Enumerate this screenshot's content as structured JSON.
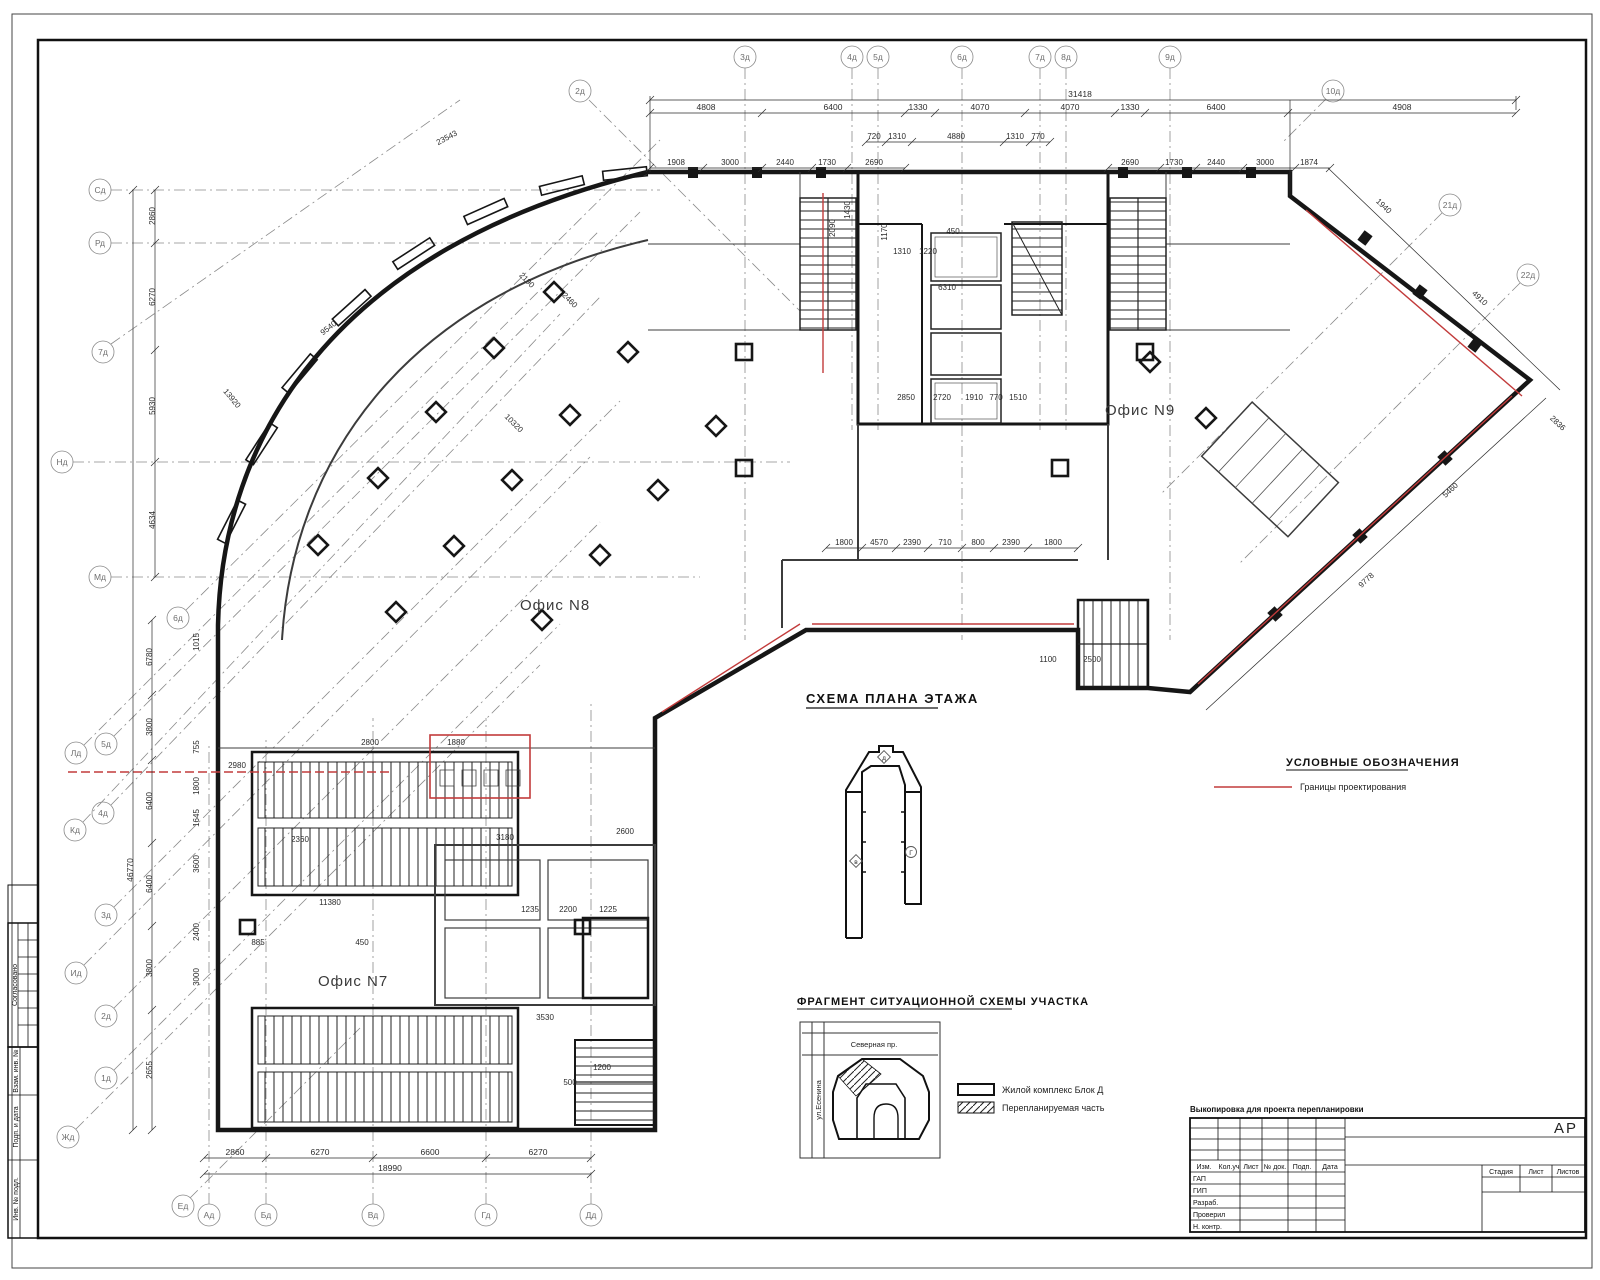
{
  "sheet": {
    "stamp_strip": {
      "agreed_label": "Согласовано",
      "rows": [
        "Взам. инв. №",
        "Подп. и дата",
        "Инв. № подл."
      ]
    }
  },
  "plan": {
    "offices": {
      "n7": "Офис N7",
      "n8": "Офис N8",
      "n9": "Офис N9"
    },
    "axes": {
      "top": [
        "2д",
        "3д",
        "4д",
        "5д",
        "6д",
        "7д",
        "8д",
        "9д",
        "10д"
      ],
      "right": [
        "21д",
        "22д"
      ],
      "left": [
        "Сд",
        "Рд",
        "7д",
        "Нд",
        "Мд",
        "6д",
        "Лд",
        "5д",
        "Кд",
        "4д",
        "3д",
        "Ид",
        "2д",
        "1д",
        "Жд"
      ],
      "bottom": [
        "Ед",
        "Ад",
        "Бд",
        "Вд",
        "Гд",
        "Дд"
      ]
    }
  },
  "dims": {
    "top_total": "31418",
    "top_chain": [
      "4808",
      "6400",
      "1330",
      "4070",
      "4070",
      "1330",
      "6400",
      "4908"
    ],
    "top_sub_left": [
      "1908",
      "3000",
      "2440",
      "1730",
      "2690"
    ],
    "top_sub_right": [
      "2690",
      "1730",
      "2440",
      "3000",
      "1874"
    ],
    "core_top": [
      "720",
      "1310",
      "4880",
      "1310",
      "770"
    ],
    "bottom_chain": [
      "2860",
      "6270",
      "6600",
      "6270"
    ],
    "bottom_total": "18990",
    "left_upper": [
      "2860",
      "6270",
      "5930",
      "4634"
    ],
    "left_lower": [
      "6780",
      "3800",
      "6400",
      "6400",
      "3800",
      "2655"
    ],
    "left_total": "46770",
    "right_diag": [
      "1940",
      "4910",
      "5460",
      "2836",
      "9778"
    ],
    "mid_chain": [
      "1800",
      "4570",
      "2390",
      "710",
      "800",
      "2390",
      "1800"
    ],
    "arc": [
      "23543",
      "13920",
      "10320",
      "2190",
      "2460",
      "9540"
    ],
    "interior": [
      "2850",
      "2720",
      "1910",
      "770",
      "1510",
      "6310",
      "1310",
      "1220",
      "450",
      "1170",
      "2090",
      "1430",
      "2980",
      "2800",
      "1880",
      "3180",
      "2360",
      "11380",
      "885",
      "450",
      "3530",
      "2600",
      "1100",
      "2500",
      "1200",
      "500",
      "1235",
      "2200",
      "1225",
      "1645",
      "3600",
      "2400",
      "3000",
      "1015",
      "755",
      "1800"
    ]
  },
  "floor_scheme": {
    "title": "СХЕМА ПЛАНА ЭТАЖА",
    "markers": [
      "д",
      "в",
      "Г"
    ]
  },
  "legend": {
    "title": "УСЛОВНЫЕ ОБОЗНАЧЕНИЯ",
    "item1": "Границы проектирования"
  },
  "fragment": {
    "title": "ФРАГМЕНТ СИТУАЦИОННОЙ СХЕМЫ УЧАСТКА",
    "street_top": "Северная пр.",
    "street_left": "ул.Есенина",
    "legend_solid": "Жилой комплекс Блок Д",
    "legend_hatch": "Перепланируемая часть"
  },
  "title_block": {
    "note": "Выкопировка для проекта перепланировки",
    "code": "АР",
    "cols": [
      "Изм.",
      "Кол.уч",
      "Лист",
      "№ док.",
      "Подп.",
      "Дата"
    ],
    "rows": [
      "ГАП",
      "ГИП",
      "Разраб.",
      "Проверил",
      "Н. контр."
    ],
    "stage": [
      "Стадия",
      "Лист",
      "Листов"
    ]
  }
}
